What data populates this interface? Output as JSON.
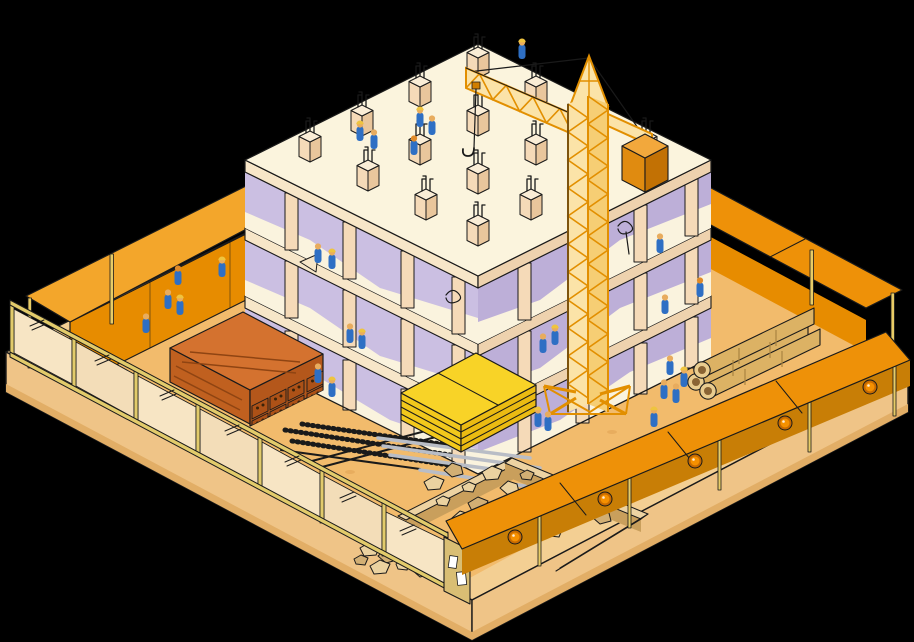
{
  "meta": {
    "subject": "Isometric illustration of a construction site on a black background",
    "canvas": {
      "width": 914,
      "height": 642
    }
  },
  "palette": {
    "background": "#000000",
    "ink": "#1A1A1A",
    "platformTop": "#F3CF93",
    "platformSide": "#EFC487",
    "platformSideDark": "#E2AE66",
    "sand": "#F2BB6C",
    "sandShade": "#E0A254",
    "canopyLight": "#F3A62B",
    "canopyMid": "#EE9108",
    "canopyDeep": "#E78C00",
    "canopyWedge": "#F5C273",
    "walkShadow": "#C87E06",
    "lampOuter": "#C76A00",
    "lampInner": "#F59000",
    "post": "#E8CC66",
    "fencePanel": "#F7E5C4",
    "fencePanelAlt": "#F3DDB8",
    "fenceFrame": "#E2CB6B",
    "gateColor": "#D9BE74",
    "paper": "#FFFFFF",
    "slabTop": "#FBF4DD",
    "slabEdgeSW": "#F7E6C8",
    "slabEdgeSE": "#EED2AE",
    "faceCream": "#FAF3DE",
    "lavender": "#CBBFE2",
    "lavenderDeep": "#BDAFD8",
    "column": "#F5DAB8",
    "columnSide": "#E9C69C",
    "stubTop": "#FAEDD6",
    "craneFill": "#FBE3A8",
    "craneFillDark": "#F6CE74",
    "crane": "#E28F00",
    "craneDark": "#D07E00",
    "cwTop": "#F2A83C",
    "cwLeft": "#E08B10",
    "cwRight": "#C27104",
    "brickTop": "#D4722F",
    "brickLeft": "#C0601F",
    "brickRight": "#B4571B",
    "brickUnit": "#AC5117",
    "brickStreak": "#8F4412",
    "brickHole": "#3A2208",
    "lumberTop": "#F8D327",
    "lumberLeft": "#F2C81C",
    "lumberRight": "#EBBB12",
    "pipeBody": "#DCB264",
    "pipeEnd": "#E9CC8F",
    "pipeHole": "#8A6434",
    "pipeSeam": "#A98441",
    "rock": "#EBD2A0",
    "rockShade": "#D2AF74",
    "binWallTop": "#EDD3A2",
    "binWallIn": "#C99F5C",
    "rebarGray": "#B9BDC6",
    "workerBody": "#2E6FC4",
    "workerHead": "#E8AC5E",
    "workerHat": "#EFC43F",
    "workerHatOrange": "#E08A28"
  },
  "scene": {
    "site": {
      "platform": "raised sandy site platform",
      "perimeter": [
        "panel fence along front-left edge",
        "orange covered scaffolding wall along back-left edge",
        "orange covered scaffolding wall along back-right edge",
        "orange covered walkway canopy along front-right edge"
      ],
      "gate_notices": 2
    },
    "building": {
      "type": "concrete frame under construction",
      "visible_floors": 3,
      "roof_column_stubs": 16
    },
    "crane": {
      "type": "tower crane",
      "parts": [
        "tower",
        "apex",
        "jib",
        "counter-jib",
        "counterweight",
        "tie lines",
        "hook",
        "splayed base"
      ]
    },
    "materials": [
      {
        "name": "brick-stack"
      },
      {
        "name": "lumber-stack"
      },
      {
        "name": "rebar-bundles"
      },
      {
        "name": "concrete-pipes",
        "count": 3
      },
      {
        "name": "gravel-bin"
      }
    ],
    "workers": {
      "count": 29
    },
    "walkway_lamps": {
      "count": 5
    }
  }
}
